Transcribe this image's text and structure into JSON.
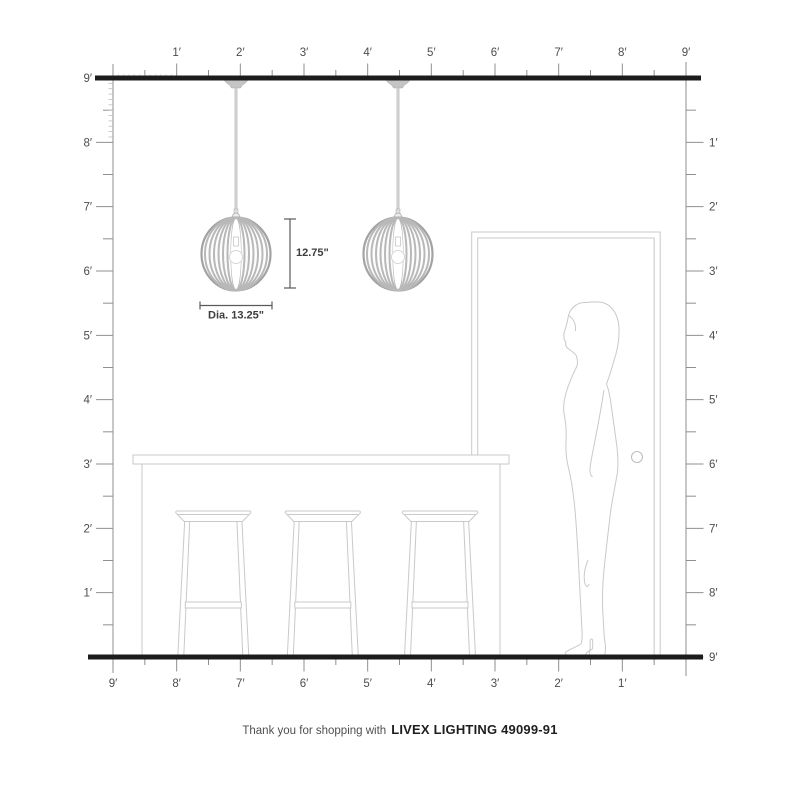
{
  "diagram": {
    "caption": {
      "prefix": "Thank you for shopping with",
      "brand": "LIVEX LIGHTING 49099-91"
    },
    "dimension_labels": {
      "height": "12.75\"",
      "diameter": "Dia. 13.25\""
    },
    "rulers": {
      "top": [
        "1′",
        "2′",
        "3′",
        "4′",
        "5′",
        "6′",
        "7′",
        "8′",
        "9′"
      ],
      "bottom": [
        "9′",
        "8′",
        "7′",
        "6′",
        "5′",
        "4′",
        "3′",
        "2′",
        "1′"
      ],
      "left": [
        "9′",
        "8′",
        "7′",
        "6′",
        "5′",
        "4′",
        "3′",
        "2′",
        "1′"
      ],
      "right": [
        "1′",
        "2′",
        "3′",
        "4′",
        "5′",
        "6′",
        "7′",
        "8′",
        "9′"
      ]
    },
    "scene_objects": [
      "ceiling",
      "floor",
      "pendant-light",
      "pendant-light",
      "kitchen-island",
      "bar-stool",
      "bar-stool",
      "bar-stool",
      "door",
      "woman-silhouette"
    ],
    "colors": {
      "structure_line": "#1c1c1c",
      "ruler_line": "#8f8f8f",
      "ruler_text": "#4c4c4c",
      "furniture_outline": "#c9c9c9",
      "pendant_gray": "#b5b5b5",
      "dimension_line": "#5a5a5a",
      "background": "#ffffff"
    }
  }
}
